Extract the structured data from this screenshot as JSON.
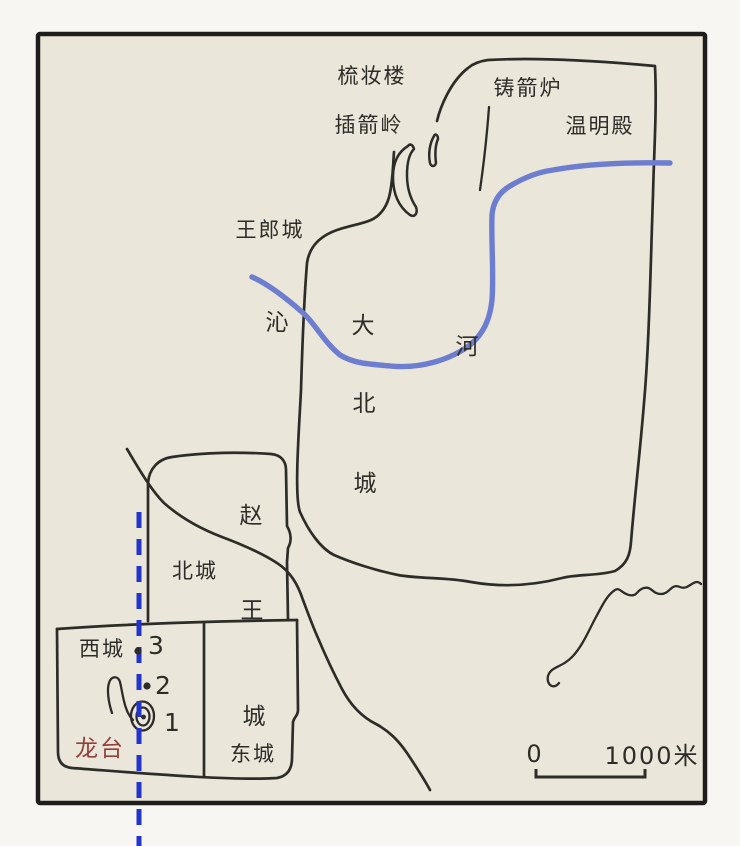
{
  "map": {
    "landmarks": {
      "shuzhuanglou": "梳妆楼",
      "chajianling": "插箭岭",
      "zhujianlu": "铸箭炉",
      "wenmingdian": "温明殿",
      "wanglangcheng": "王郎城"
    },
    "river": {
      "qin_char": "沁",
      "he_char": "河"
    },
    "cities": {
      "dabeicheng_chars": [
        "大",
        "北",
        "城"
      ],
      "zhaowangcheng_chars": [
        "赵",
        "王",
        "城"
      ],
      "beicheng": "北城",
      "xicheng": "西城",
      "dongcheng": "东城"
    },
    "longtai": "龙台",
    "markers": [
      {
        "label": "1"
      },
      {
        "label": "2"
      },
      {
        "label": "3"
      }
    ],
    "scale_bar": {
      "start": "0",
      "end": "1000米"
    },
    "colors": {
      "paper": "#eae6da",
      "page": "#f7f6f2",
      "ink": "#2e2c28",
      "frame": "#1e1d1b",
      "river": "#6d7dd0",
      "transect": "#2334cb",
      "longtai": "#93403a"
    }
  }
}
